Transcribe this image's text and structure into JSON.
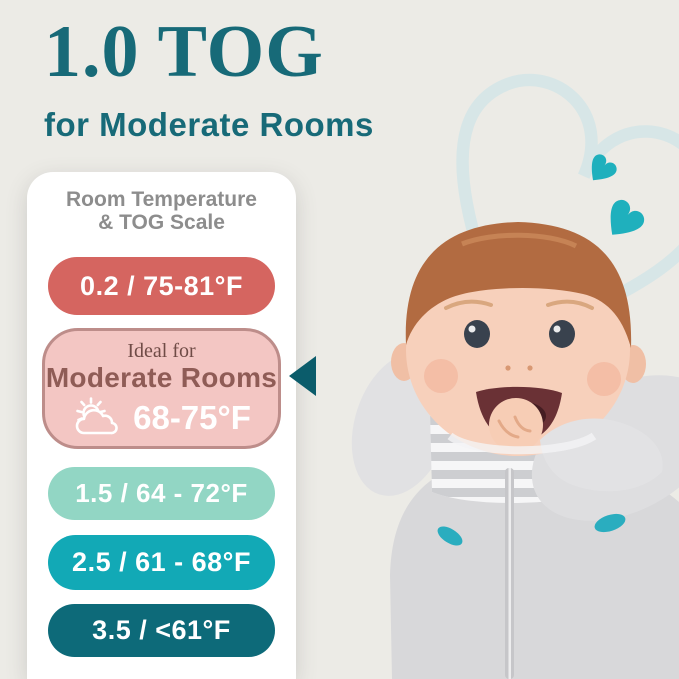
{
  "header": {
    "title": "1.0 TOG",
    "subtitle": "for Moderate Rooms"
  },
  "card": {
    "heading_line1": "Room Temperature",
    "heading_line2": "& TOG Scale",
    "pills": [
      {
        "id": "tog-0.2",
        "label": "0.2 / 75-81°F",
        "bg": "#d56560",
        "fg": "#ffffff"
      },
      {
        "id": "tog-1.5",
        "label": "1.5 / 64 - 72°F",
        "bg": "#92d6c4",
        "fg": "#ffffff"
      },
      {
        "id": "tog-2.5",
        "label": "2.5 / 61 - 68°F",
        "bg": "#12a9b6",
        "fg": "#ffffff"
      },
      {
        "id": "tog-3.5",
        "label": "3.5 / <61°F",
        "bg": "#0d6a79",
        "fg": "#ffffff"
      }
    ],
    "ideal": {
      "eyebrow": "Ideal for",
      "room": "Moderate Rooms",
      "temp": "68-75°F",
      "icon": "sun-behind-cloud-icon",
      "bg": "#f3c6c3",
      "border": "#bd8d8a",
      "eyebrow_color": "#6f4b46",
      "room_color": "#8f5c56",
      "temp_color": "#ffffff"
    }
  },
  "colors": {
    "background": "#ecebe6",
    "accent_teal": "#176a78",
    "card_bg": "#ffffff",
    "heading_gray": "#8d8d8d",
    "pointer_arrow": "#0b5c6b",
    "solid_hearts": "#1fb0bd",
    "heart_outline": "#d7e6e7",
    "swaddle_gray": "#d9d9db"
  },
  "decor": {
    "heart_outline": "large-heart-outline",
    "small_heart": "small-teal-heart",
    "large_heart": "large-teal-heart",
    "photo": "baby-chewing-hand-in-gray-arms-up-swaddle"
  }
}
